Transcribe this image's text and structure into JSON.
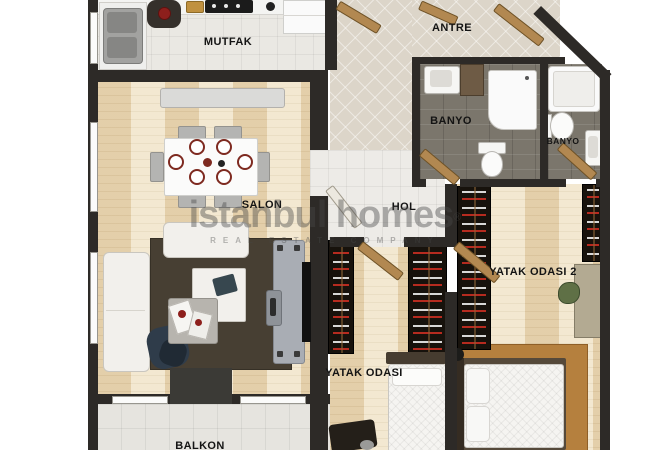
{
  "image_type": "apartment floor plan (2 bedroom)",
  "watermark": {
    "brand": "istanbul homes",
    "registered": "®",
    "tagline": "REAL ESTATE COMPANY"
  },
  "rooms": {
    "kitchen": {
      "label": "MUTFAK"
    },
    "entry": {
      "label": "ANTRE"
    },
    "bathroom_main": {
      "label": "BANYO"
    },
    "bathroom_second": {
      "label": "BANYO"
    },
    "living_room": {
      "label": "SALON"
    },
    "hall": {
      "label": "HOL"
    },
    "bedroom_2": {
      "label": "YATAK ODASI 2"
    },
    "bedroom_1": {
      "label": "YATAK ODASI"
    },
    "balcony": {
      "label": "BALKON"
    }
  },
  "palette": {
    "wall": "#2d2a27",
    "wood_floor": "#f0e4ca",
    "bath_tile": "#7b766c",
    "kitchen_tile": "#eae8e3",
    "entry_tile": "#dcd5c9",
    "living_rug": "#473f33",
    "bedroom_rug": "#b5803e",
    "white_furniture": "#f2f0ec",
    "gray_furniture": "#b7b4ae",
    "wood_door": "#b28851",
    "plate_rim": "#7e2a20"
  }
}
